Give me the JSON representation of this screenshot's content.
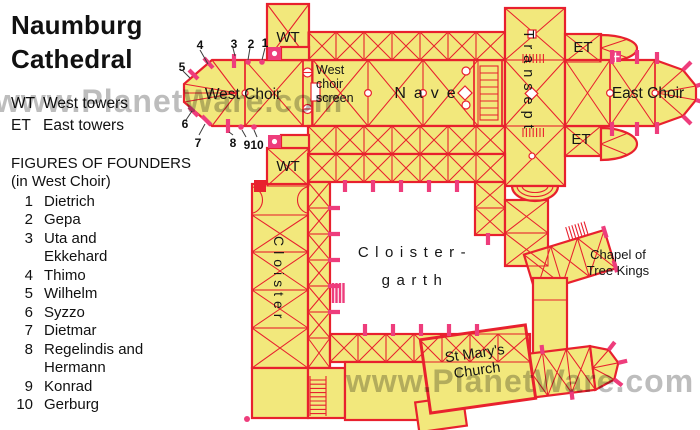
{
  "title": "Naumburg Cathedral",
  "legend": {
    "items": [
      {
        "abbr": "WT",
        "label": "West towers"
      },
      {
        "abbr": "ET",
        "label": "East towers"
      }
    ]
  },
  "founders": {
    "heading": "FIGURES OF FOUNDERS",
    "subheading": "(in West Choir)",
    "items": [
      {
        "num": "1",
        "name": "Dietrich"
      },
      {
        "num": "2",
        "name": "Gepa"
      },
      {
        "num": "3",
        "name": "Uta and Ekkehard"
      },
      {
        "num": "4",
        "name": "Thimo"
      },
      {
        "num": "5",
        "name": "Wilhelm"
      },
      {
        "num": "6",
        "name": "Syzzo"
      },
      {
        "num": "7",
        "name": "Dietmar"
      },
      {
        "num": "8",
        "name": "Regelindis and Hermann"
      },
      {
        "num": "9",
        "name": "Konrad"
      },
      {
        "num": "10",
        "name": "Gerburg"
      }
    ]
  },
  "plan": {
    "labels": {
      "wt_north": "WT",
      "wt_south": "WT",
      "et_north": "ET",
      "et_south": "ET",
      "west_choir": "West Choir",
      "west_choir_screen_l1": "West",
      "west_choir_screen_l2": "choir",
      "west_choir_screen_l3": "screen",
      "nave": "Nave",
      "transept": "Transept",
      "east_choir": "East Choir",
      "cloister": "Cloister",
      "cloister_garth_l1": "Cloister-",
      "cloister_garth_l2": "garth",
      "chapel_l1": "Chapel of",
      "chapel_l2": "Tree Kings",
      "st_marys_l1": "St Mary's",
      "st_marys_l2": "Church"
    }
  },
  "watermark": {
    "text_top": "www.PlanetWare.com",
    "text_bottom": "www.PlanetWare.com"
  },
  "colors": {
    "plan_fill": "#F2E87C",
    "line_red": "#E8212E",
    "accent_pink": "#EE3D7C",
    "watermark_gray": "#ADADAD",
    "background": "#FFFFFF",
    "text": "#111111"
  }
}
